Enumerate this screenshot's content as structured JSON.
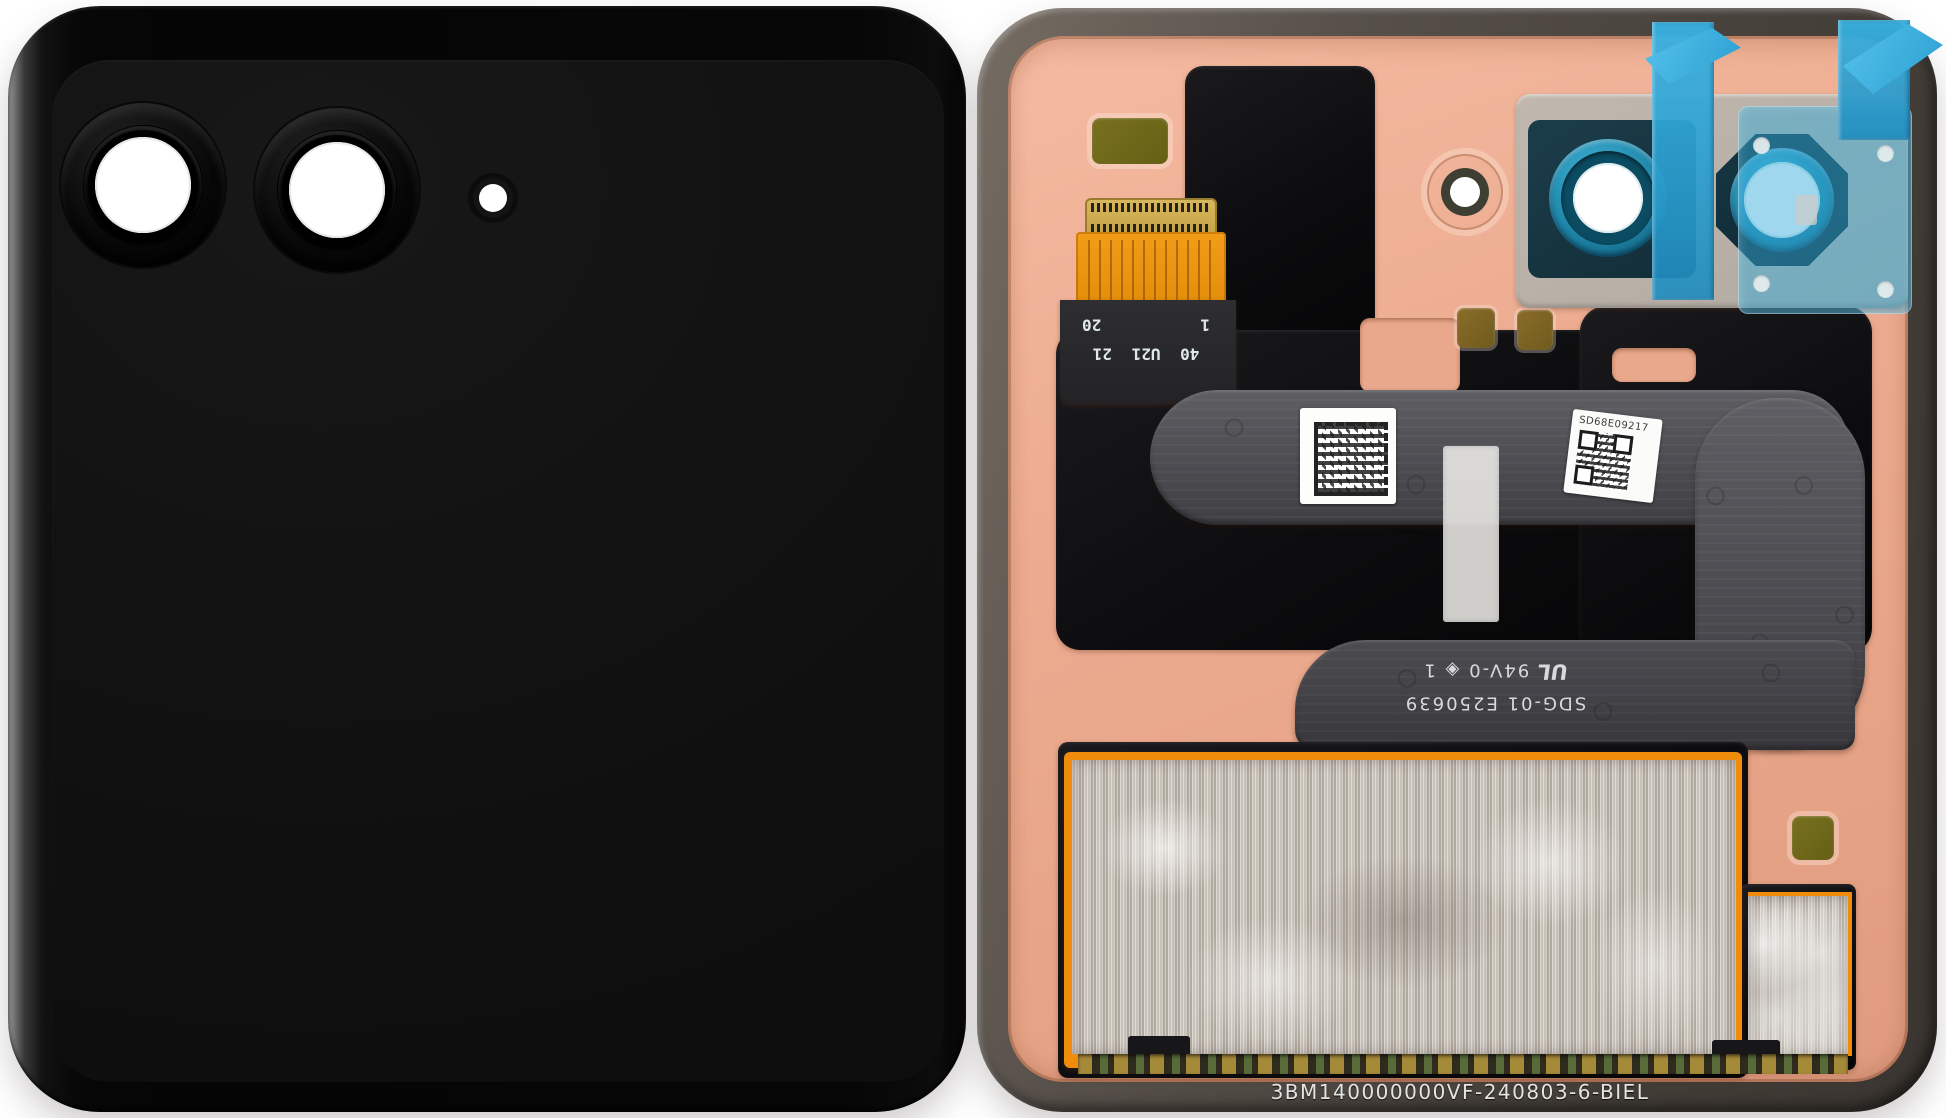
{
  "scene": {
    "left_cover": {
      "type": "glossy-black-cover-glass",
      "camera_cutouts": 2,
      "flash_cutouts": 1,
      "body_color": "#070707"
    },
    "right_assembly": {
      "connector": {
        "row_pins": "40 U21 21",
        "pin_first": "1",
        "pin_last": "20"
      },
      "ribbon_marking": {
        "part_number": "SDG-01 E250639",
        "ul_mark": "UL",
        "rating": "94V-0",
        "symbol": "◈",
        "revision": "1"
      },
      "serial_label": {
        "serial": "SD68E09217"
      },
      "bottom_marking": "3BM140000000VF-240803-6-BIEL",
      "colors": {
        "copper_panel": "#eca98e",
        "blue_tape": "#2fa8dc",
        "teal_lens_ring": "#1e85a8",
        "orange_flex": "#ef9414",
        "olive_sticker": "#6d671b",
        "frame_gray": "#57504a",
        "ribbon_gray": "#4c4c51",
        "weave_silver": "#beb7ad"
      }
    }
  }
}
